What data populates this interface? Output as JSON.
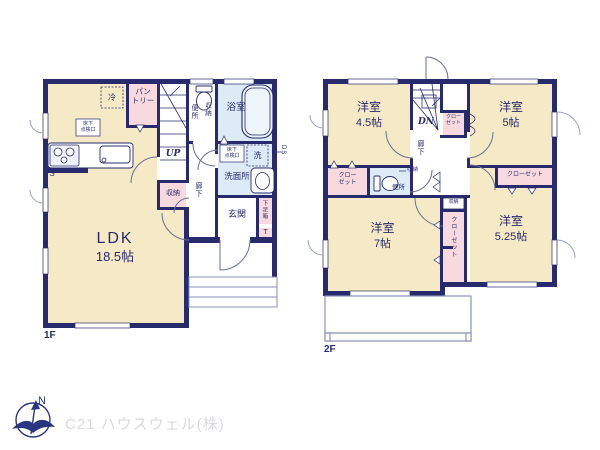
{
  "f1": {
    "floor_label": "1F",
    "ldk_name": "LDK",
    "ldk_size": "18.5帖",
    "pantry": "パン\nトリー",
    "fridge": "冷",
    "hatch_kitchen": "床下\n点検口",
    "ps": "PS",
    "up": "UP",
    "toilet": "便所",
    "toilet_storage": "収納",
    "bath": "浴室",
    "hatch_wash": "床下\n点検口",
    "washer": "洗",
    "duct": "DS",
    "washroom": "洗面所",
    "storage": "収納",
    "hallway": "廊下",
    "entrance": "玄関",
    "shoe_box": "下足箱",
    "shoe_t": "T"
  },
  "f2": {
    "floor_label": "2F",
    "room_nw_name": "洋室",
    "room_nw_size": "4.5帖",
    "room_ne_name": "洋室",
    "room_ne_size": "5帖",
    "room_sw_name": "洋室",
    "room_sw_size": "7帖",
    "room_se_name": "洋室",
    "room_se_size": "5.25帖",
    "dn": "DN",
    "closet_stairs": "クロー\nゼット",
    "closet_west": "クロー\nゼット",
    "closet_east": "クローゼット",
    "closet_center": "クローゼット",
    "hallway": "廊下",
    "hall_storage": "収納",
    "center_storage": "収納",
    "toilet": "便所"
  },
  "footer": {
    "compass_n": "N",
    "company": "C21 ハウスウェル(株)"
  },
  "colors": {
    "wall": "#272b6e",
    "room": "#f6e9c5",
    "closet": "#f8dade",
    "wet": "#dcebf5",
    "outline": "#8a92bb",
    "watermark": "#d9dade"
  }
}
